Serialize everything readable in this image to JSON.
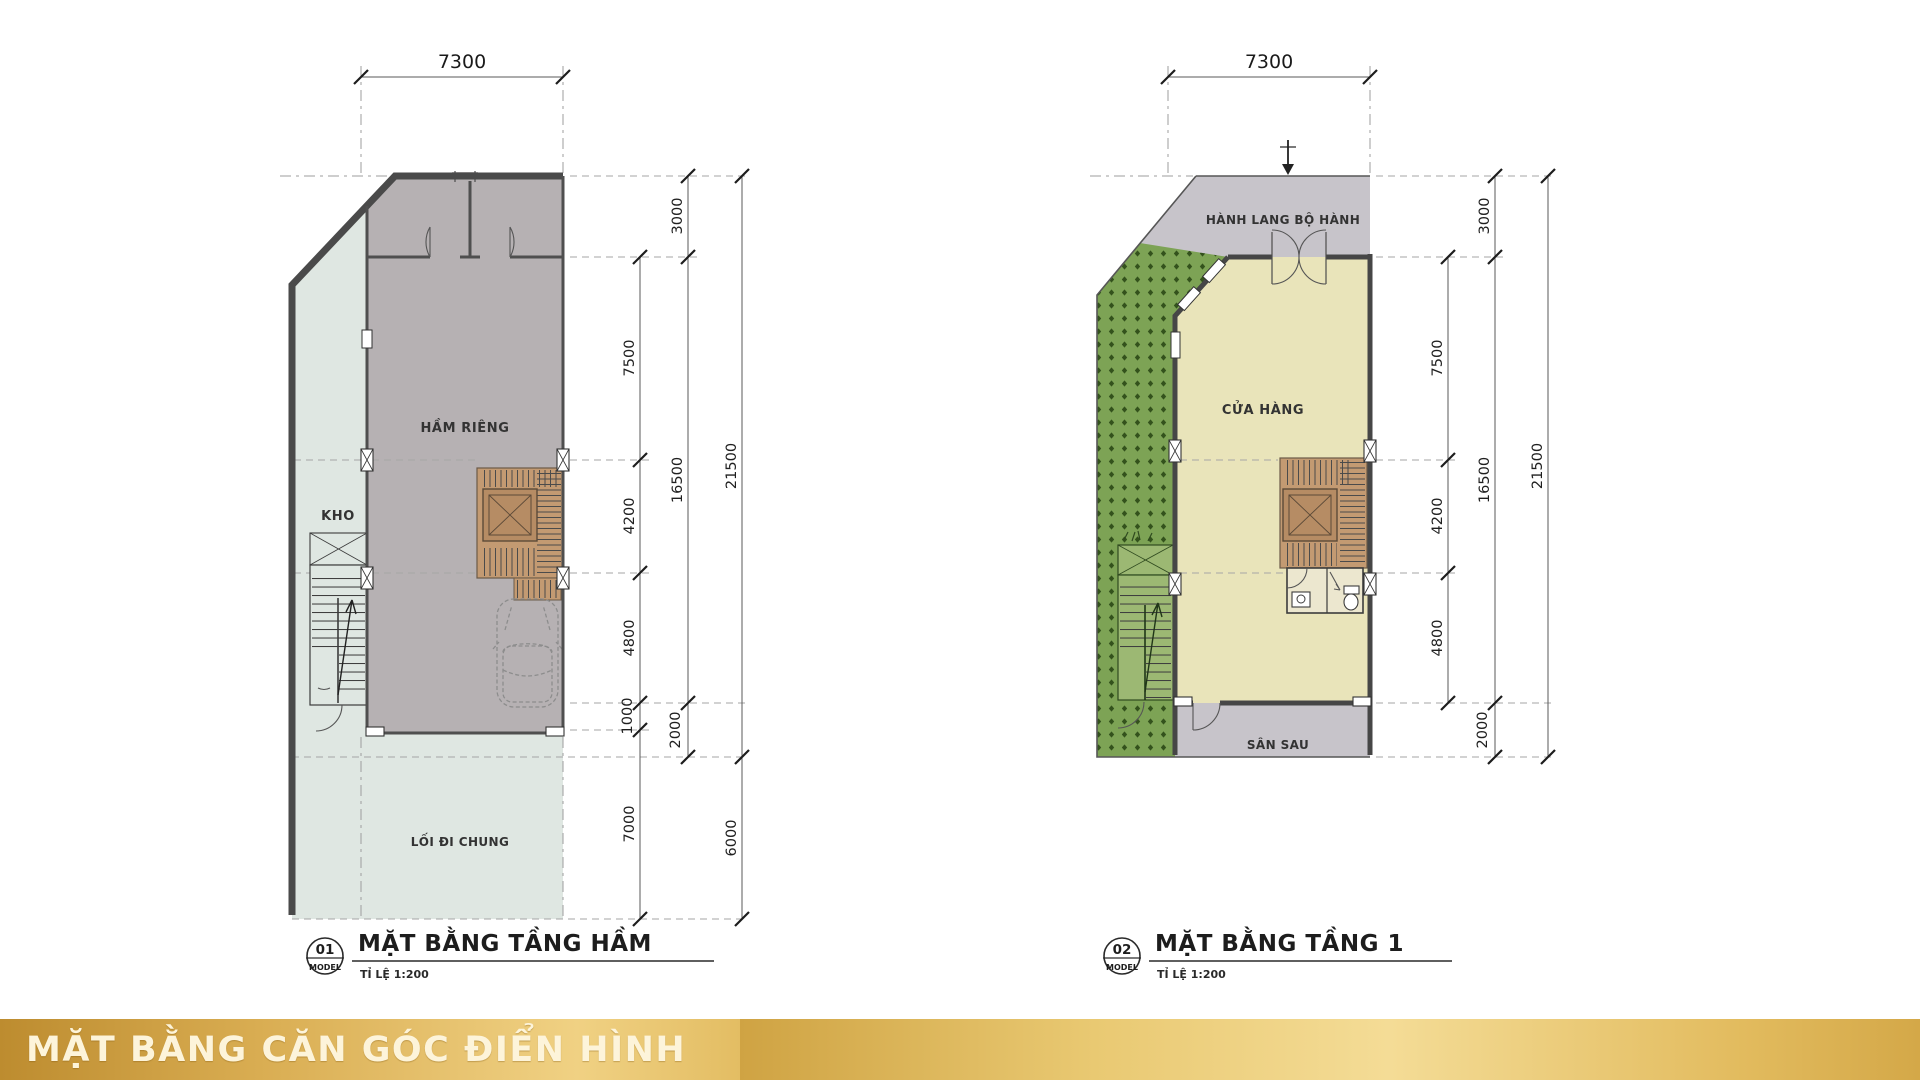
{
  "banner": {
    "title": "MẶT BẰNG CĂN GÓC ĐIỂN HÌNH",
    "gold_dark": "#bd8c2f",
    "gold_light": "#f4dc96"
  },
  "plans": {
    "left": {
      "badge_number": "01",
      "badge_label": "MODEL",
      "title": "MẶT BẰNG TẦNG HẦM",
      "scale_note": "TỈ LỆ 1:200",
      "rooms": {
        "private_basement": "HẦM RIÊNG",
        "storage": "KHO",
        "common_walkway": "LỐI ĐI CHUNG"
      },
      "dims": {
        "top": "7300",
        "inner": [
          "7500",
          "4200",
          "4800",
          "1000",
          "7000"
        ],
        "middle": [
          "3000",
          "16500",
          "2000"
        ],
        "outer": [
          "21500",
          "6000"
        ]
      }
    },
    "right": {
      "badge_number": "02",
      "badge_label": "MODEL",
      "title": "MẶT BẰNG TẦNG 1",
      "scale_note": "TỈ LỆ 1:200",
      "rooms": {
        "pedestrian_corridor": "HÀNH LANG BỘ HÀNH",
        "shop": "CỬA HÀNG",
        "back_yard": "SÂN SAU"
      },
      "dims": {
        "top": "7300",
        "inner": [
          "7500",
          "4200",
          "4800"
        ],
        "middle": [
          "3000",
          "16500",
          "2000"
        ],
        "outer": [
          "21500"
        ]
      }
    }
  },
  "colors": {
    "basement_floor": "#b6b1b3",
    "common_area": "#dfe7e2",
    "shop_floor": "#e9e4ba",
    "corridor_grey": "#c7c4ca",
    "landscape_green": "#7da355",
    "stair_brown": "#c39a72",
    "wall_dark": "#4a4a4a"
  }
}
